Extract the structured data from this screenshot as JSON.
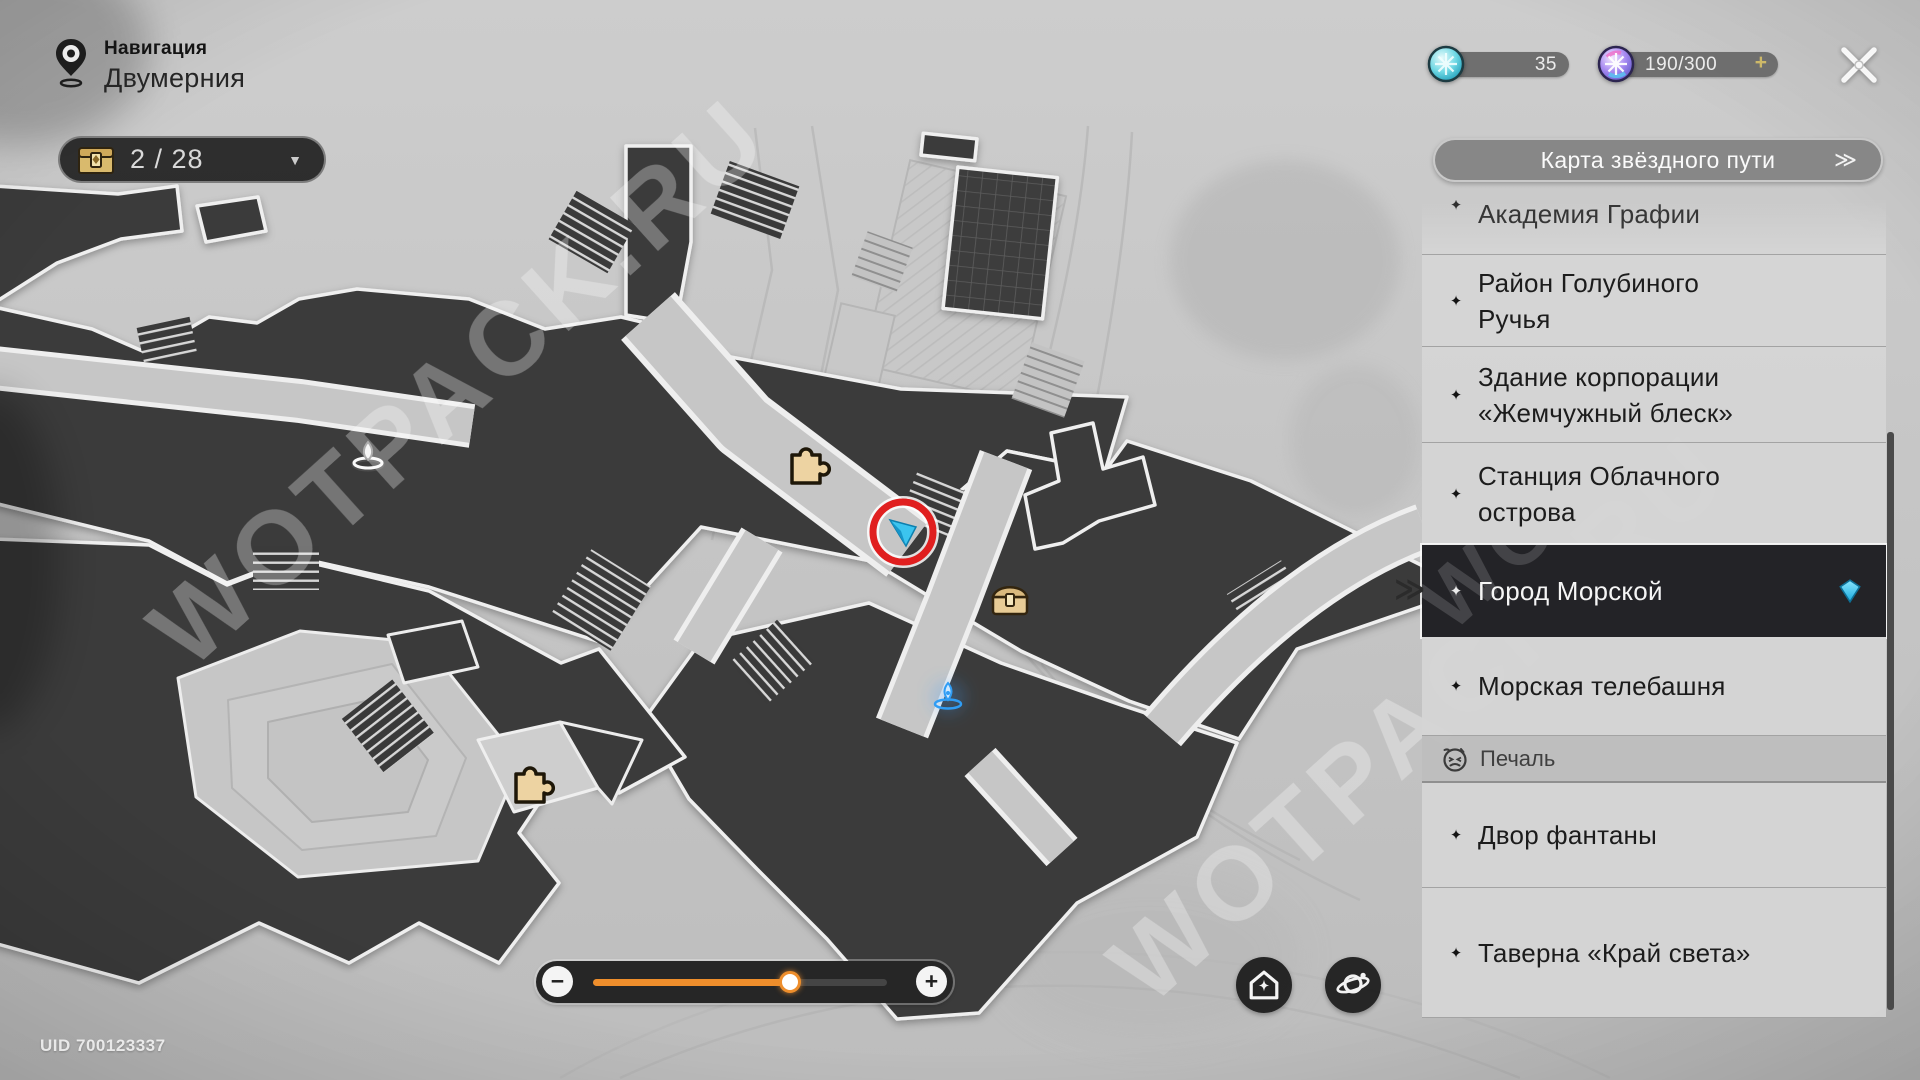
{
  "header": {
    "nav_label": "Навигация",
    "location_name": "Двумерния",
    "chest_counter": "2 / 28"
  },
  "currencies": {
    "fuel": {
      "value": "35"
    },
    "trailblaze_power": {
      "value": "190/300",
      "plus": "+"
    }
  },
  "sidebar": {
    "map_button": {
      "label": "Карта звёздного пути",
      "chevron": "≫"
    },
    "selected_indicator": "≫",
    "items": [
      {
        "lines": [
          "Академия Графии"
        ],
        "type": "clipped"
      },
      {
        "lines": [
          "Район Голубиного",
          "Ручья"
        ],
        "type": "normal"
      },
      {
        "lines": [
          "Здание корпорации",
          "«Жемчужный блеск»"
        ],
        "type": "normal"
      },
      {
        "lines": [
          "Станция Облачного",
          "острова"
        ],
        "type": "normal"
      },
      {
        "lines": [
          "Город Морской"
        ],
        "type": "selected"
      },
      {
        "lines": [
          "Морская телебашня"
        ],
        "type": "normal"
      },
      {
        "lines": [
          "Печаль"
        ],
        "type": "section"
      },
      {
        "lines": [
          "Двор фантаны"
        ],
        "type": "normal"
      },
      {
        "lines": [
          "Таверна «Край света»"
        ],
        "type": "normal"
      }
    ]
  },
  "slider": {
    "minus": "−",
    "plus": "+",
    "value_percent": 67
  },
  "footer": {
    "uid": "UID 700123337"
  },
  "map": {
    "watermark": "WOTPACK.RU"
  },
  "icons": {
    "dropdown_arrow": "▼",
    "star_bullet": "✦"
  },
  "colors": {
    "accent_orange": "#ee8e2c",
    "marker_red": "#e01f1f",
    "marker_cyan": "#39c2ee",
    "selected_bg": "#232327"
  }
}
